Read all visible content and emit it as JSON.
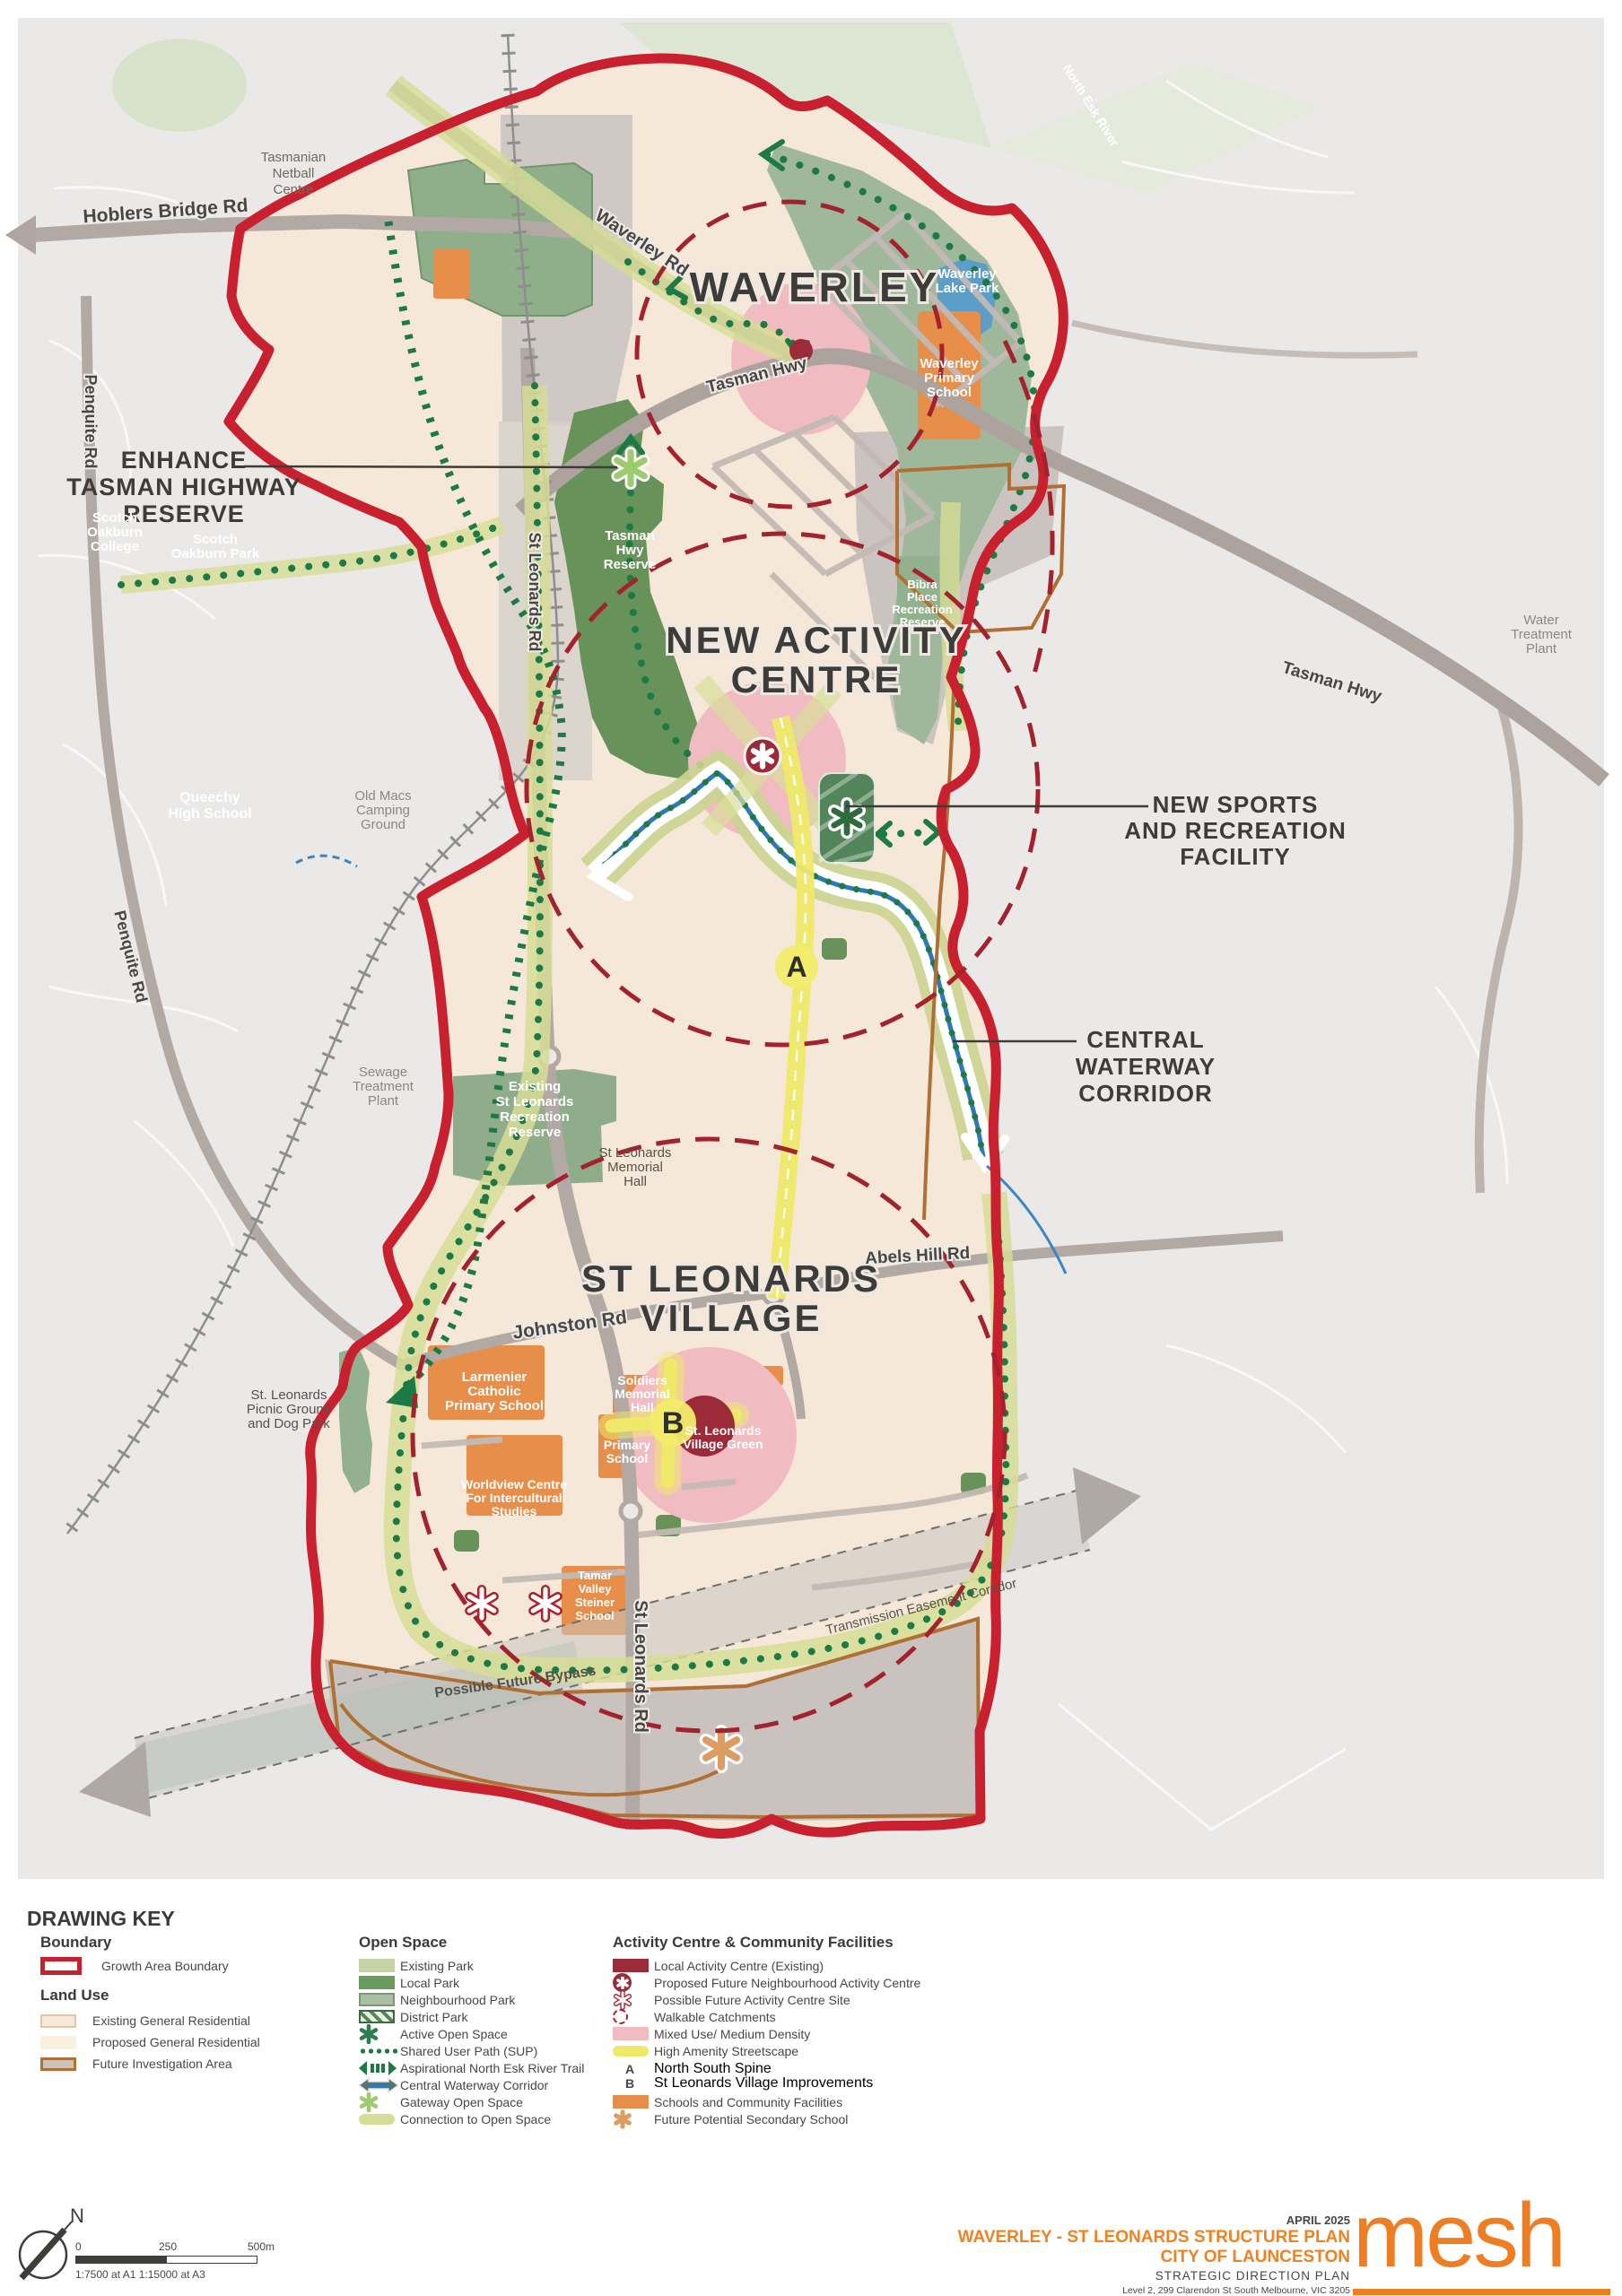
{
  "map": {
    "titles": {
      "waverley": "WAVERLEY",
      "nac": [
        "NEW ACTIVITY",
        "CENTRE"
      ],
      "slv": [
        "ST LEONARDS",
        "VILLAGE"
      ]
    },
    "callouts": {
      "enhance": [
        "ENHANCE",
        "TASMAN HIGHWAY",
        "RESERVE"
      ],
      "sports": [
        "NEW SPORTS",
        "AND RECREATION",
        "FACILITY"
      ],
      "waterway": [
        "CENTRAL",
        "WATERWAY",
        "CORRIDOR"
      ]
    },
    "roads": {
      "hoblers": "Hoblers Bridge Rd",
      "waverley_rd": "Waverley Rd",
      "tasman_top": "Tasman Hwy",
      "tasman_right": "Tasman Hwy",
      "st_leonards_upper": "St Leonards Rd",
      "st_leonards_lower": "St Leonards Rd",
      "johnston": "Johnston Rd",
      "abels": "Abels Hill Rd",
      "penquite_upper": "Penquite Rd",
      "penquite_lower": "Penquite Rd",
      "bypass": "Possible Future Bypass",
      "transmission": "Transmission Easement Corridor",
      "north_esk": "North Esk River"
    },
    "places": {
      "netball": [
        "Tasmanian",
        "Netball",
        "Centre"
      ],
      "scotch_college": [
        "Scotch",
        "Oakburn",
        "College"
      ],
      "scotch_park": [
        "Scotch",
        "Oakburn Park"
      ],
      "queechy": [
        "Queechy",
        "High School"
      ],
      "old_macs": [
        "Old Macs",
        "Camping",
        "Ground"
      ],
      "sewage": [
        "Sewage",
        "Treatment",
        "Plant"
      ],
      "water_plant": [
        "Water",
        "Treatment",
        "Plant"
      ],
      "tasman_reserve": [
        "Tasman",
        "Hwy",
        "Reserve"
      ],
      "bibra": [
        "Bibra",
        "Place",
        "Recreation",
        "Reserve"
      ],
      "lake_park": [
        "Waverley",
        "Lake Park"
      ],
      "waverley_ps": [
        "Waverley",
        "Primary",
        "School"
      ],
      "rec_reserve": [
        "Existing",
        "St Leonards",
        "Recreation",
        "Reserve"
      ],
      "memorial_hall": [
        "St Leonards",
        "Memorial",
        "Hall"
      ],
      "picnic": [
        "St. Leonards",
        "Picnic Ground",
        "and Dog Park"
      ],
      "larmenier": [
        "Larmenier",
        "Catholic",
        "Primary School"
      ],
      "soldiers": [
        "Soldiers",
        "Memorial",
        "Hall"
      ],
      "primary_school": [
        "Primary",
        "School"
      ],
      "village_green": [
        "St. Leonards",
        "Village Green"
      ],
      "worldview": [
        "Worldview Centre",
        "For Intercultural",
        "Studies"
      ],
      "tamar": [
        "Tamar",
        "Valley",
        "Steiner",
        "School"
      ]
    },
    "markers": {
      "a": "A",
      "b": "B"
    }
  },
  "drawing_key": {
    "title": "DRAWING KEY",
    "boundary": {
      "title": "Boundary",
      "items": [
        "Growth Area Boundary"
      ]
    },
    "land_use": {
      "title": "Land Use",
      "items": [
        "Existing General Residential",
        "Proposed General Residential",
        "Future Investigation Area"
      ]
    },
    "open_space": {
      "title": "Open Space",
      "items": [
        "Existing Park",
        "Local Park",
        "Neighbourhood Park",
        "District Park",
        "Active Open Space",
        "Shared User Path (SUP)",
        "Aspirational North Esk River Trail",
        "Central Waterway Corridor",
        "Gateway Open Space",
        "Connection to Open Space"
      ]
    },
    "activity": {
      "title": "Activity Centre & Community Facilities",
      "items": [
        "Local Activity Centre (Existing)",
        "Proposed Future Neighbourhood Activity Centre",
        "Possible Future Activity Centre Site",
        "Walkable Catchments",
        "Mixed Use/ Medium Density",
        "High Amenity Streetscape",
        "Schools and Community Facilities",
        "Future Potential Secondary School"
      ],
      "sub_items": [
        {
          "key": "A",
          "label": "North South Spine"
        },
        {
          "key": "B",
          "label": "St Leonards Village Improvements"
        }
      ]
    }
  },
  "footer": {
    "north": "N",
    "scale": {
      "t0": "0",
      "t250": "250",
      "t500": "500m",
      "ratio": "1:7500 at A1  1:15000 at A3"
    },
    "title_block": {
      "date": "APRIL 2025",
      "line1": "WAVERLEY - ST LEONARDS STRUCTURE PLAN",
      "line2": "CITY OF LAUNCESTON",
      "line3": "STRATEGIC DIRECTION PLAN",
      "address": "Level 2, 299 Clarendon St South Melbourne, VIC 3205",
      "contact": "t 9070 1166  e info@meshplanning.com.au",
      "logo": "mesh"
    }
  },
  "colors": {
    "boundary_red": "#C8202F",
    "catchment_red": "#A2232E",
    "sup_green": "#1D7A45",
    "high_amenity_yellow": "#EFE96A",
    "schools_orange": "#E78E4B",
    "mesh_orange": "#EE7E23",
    "local_activity_red": "#9C2B39",
    "mixed_use_pink": "#F1BCC1"
  }
}
